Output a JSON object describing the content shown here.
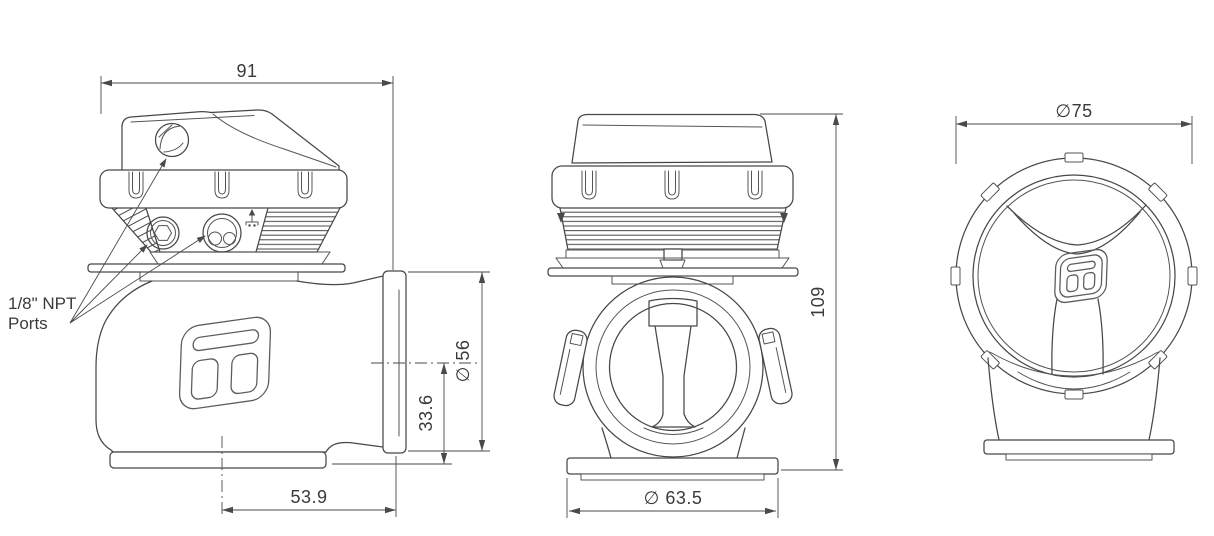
{
  "background": "#ffffff",
  "drawing": {
    "stroke_color": "#474747",
    "dim_color": "#3a3a3a",
    "ports_label": {
      "line1": "1/8\" NPT",
      "line2": "Ports"
    },
    "dimensions": {
      "top_width": "91",
      "outlet_flange_diameter": "∅ 56",
      "outlet_center_height": "33.6",
      "outlet_face_offset": "53.9",
      "overall_height": "109",
      "inlet_flange_diameter": "∅ 63.5",
      "cap_diameter": "∅75"
    }
  }
}
